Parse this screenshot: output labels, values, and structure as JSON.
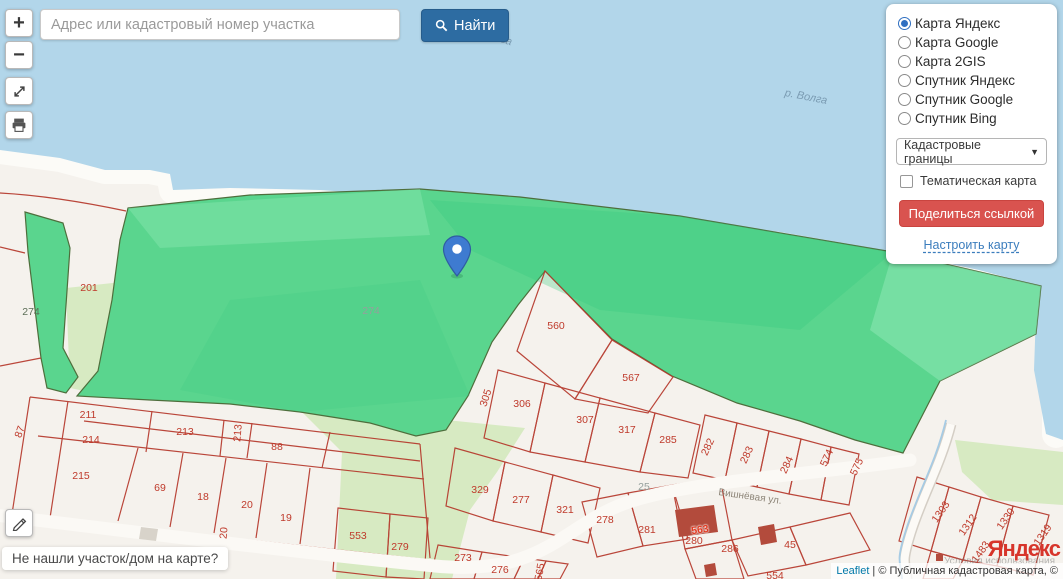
{
  "search": {
    "placeholder": "Адрес или кадастровый номер участка",
    "button": "Найти"
  },
  "zoom_controls": {
    "zoom_in": "+",
    "zoom_out": "−"
  },
  "layers_panel": {
    "options": [
      {
        "label": "Карта Яндекс",
        "selected": true
      },
      {
        "label": "Карта Google",
        "selected": false
      },
      {
        "label": "Карта 2GIS",
        "selected": false
      },
      {
        "label": "Спутник Яндекс",
        "selected": false
      },
      {
        "label": "Спутник Google",
        "selected": false
      },
      {
        "label": "Спутник Bing",
        "selected": false
      }
    ],
    "layer_select_value": "Кадастровые границы",
    "thematic_checkbox_label": "Тематическая карта",
    "share_button": "Поделиться ссылкой",
    "configure_link": "Настроить карту"
  },
  "map": {
    "help_tooltip": "Не нашли участок/дом на карте?",
    "pin": {
      "x": 457,
      "y": 256
    },
    "labels": [
      {
        "t": "Волга",
        "x": 497,
        "y": 38,
        "r": 17,
        "c": "water"
      },
      {
        "t": "р. Волга",
        "x": 806,
        "y": 97,
        "r": 11,
        "c": "water"
      },
      {
        "t": "274",
        "x": 31,
        "y": 312,
        "r": 0,
        "c": "dark"
      },
      {
        "t": "201",
        "x": 89,
        "y": 288,
        "r": 0,
        "c": "red"
      },
      {
        "t": "274",
        "x": 371,
        "y": 311,
        "r": 0,
        "c": "gray"
      },
      {
        "t": "560",
        "x": 556,
        "y": 326,
        "r": 0,
        "c": "red"
      },
      {
        "t": "567",
        "x": 631,
        "y": 378,
        "r": 0,
        "c": "red"
      },
      {
        "t": "305",
        "x": 486,
        "y": 398,
        "r": -72,
        "c": "red"
      },
      {
        "t": "306",
        "x": 522,
        "y": 404,
        "r": 0,
        "c": "red"
      },
      {
        "t": "307",
        "x": 585,
        "y": 420,
        "r": 0,
        "c": "red"
      },
      {
        "t": "317",
        "x": 627,
        "y": 430,
        "r": 0,
        "c": "red"
      },
      {
        "t": "285",
        "x": 668,
        "y": 440,
        "r": 0,
        "c": "red"
      },
      {
        "t": "282",
        "x": 708,
        "y": 447,
        "r": -65,
        "c": "red"
      },
      {
        "t": "283",
        "x": 747,
        "y": 455,
        "r": -65,
        "c": "red"
      },
      {
        "t": "284",
        "x": 787,
        "y": 465,
        "r": -65,
        "c": "red"
      },
      {
        "t": "574",
        "x": 827,
        "y": 458,
        "r": -65,
        "c": "red"
      },
      {
        "t": "575",
        "x": 857,
        "y": 467,
        "r": -65,
        "c": "red"
      },
      {
        "t": "87",
        "x": 20,
        "y": 432,
        "r": -70,
        "c": "red"
      },
      {
        "t": "211",
        "x": 88,
        "y": 415,
        "r": 0,
        "c": "red"
      },
      {
        "t": "214",
        "x": 91,
        "y": 440,
        "r": 0,
        "c": "red"
      },
      {
        "t": "213",
        "x": 185,
        "y": 432,
        "r": 0,
        "c": "red"
      },
      {
        "t": "213",
        "x": 238,
        "y": 433,
        "r": -85,
        "c": "red"
      },
      {
        "t": "88",
        "x": 277,
        "y": 447,
        "r": 0,
        "c": "red"
      },
      {
        "t": "215",
        "x": 81,
        "y": 476,
        "r": 0,
        "c": "red"
      },
      {
        "t": "69",
        "x": 160,
        "y": 488,
        "r": 0,
        "c": "red"
      },
      {
        "t": "18",
        "x": 203,
        "y": 497,
        "r": 0,
        "c": "red"
      },
      {
        "t": "20",
        "x": 247,
        "y": 505,
        "r": 0,
        "c": "red"
      },
      {
        "t": "19",
        "x": 286,
        "y": 518,
        "r": 0,
        "c": "red"
      },
      {
        "t": "20",
        "x": 224,
        "y": 533,
        "r": -85,
        "c": "red"
      },
      {
        "t": "329",
        "x": 480,
        "y": 490,
        "r": 0,
        "c": "red"
      },
      {
        "t": "277",
        "x": 521,
        "y": 500,
        "r": 0,
        "c": "red"
      },
      {
        "t": "321",
        "x": 565,
        "y": 510,
        "r": 0,
        "c": "red"
      },
      {
        "t": "278",
        "x": 605,
        "y": 520,
        "r": 0,
        "c": "red"
      },
      {
        "t": "25",
        "x": 644,
        "y": 487,
        "r": 0,
        "c": "gray"
      },
      {
        "t": "281",
        "x": 647,
        "y": 530,
        "r": 0,
        "c": "red"
      },
      {
        "t": "563",
        "x": 700,
        "y": 530,
        "r": -8,
        "c": "bld"
      },
      {
        "t": "280",
        "x": 694,
        "y": 541,
        "r": 0,
        "c": "red"
      },
      {
        "t": "286",
        "x": 730,
        "y": 549,
        "r": 0,
        "c": "red"
      },
      {
        "t": "45",
        "x": 790,
        "y": 545,
        "r": 0,
        "c": "red"
      },
      {
        "t": "554",
        "x": 775,
        "y": 576,
        "r": 0,
        "c": "red"
      },
      {
        "t": "553",
        "x": 358,
        "y": 536,
        "r": 0,
        "c": "red"
      },
      {
        "t": "279",
        "x": 400,
        "y": 547,
        "r": 0,
        "c": "red"
      },
      {
        "t": "273",
        "x": 463,
        "y": 558,
        "r": 0,
        "c": "red"
      },
      {
        "t": "276",
        "x": 500,
        "y": 570,
        "r": 0,
        "c": "red"
      },
      {
        "t": "565",
        "x": 540,
        "y": 572,
        "r": -80,
        "c": "red"
      },
      {
        "t": "1303",
        "x": 941,
        "y": 512,
        "r": -55,
        "c": "red"
      },
      {
        "t": "1312",
        "x": 968,
        "y": 525,
        "r": -55,
        "c": "red"
      },
      {
        "t": "1330",
        "x": 1006,
        "y": 519,
        "r": -55,
        "c": "red"
      },
      {
        "t": "1319",
        "x": 1043,
        "y": 535,
        "r": -55,
        "c": "red"
      },
      {
        "t": "1483",
        "x": 981,
        "y": 552,
        "r": -55,
        "c": "red"
      },
      {
        "t": "Вишнёвая ул.",
        "x": 750,
        "y": 497,
        "r": 8,
        "c": "street"
      }
    ]
  },
  "attribution": {
    "leaflet": "Leaflet",
    "separator": " | ",
    "text": "© Публичная кадастровая карта, ©",
    "logo": "Яндекс",
    "terms": "Условия использования"
  }
}
